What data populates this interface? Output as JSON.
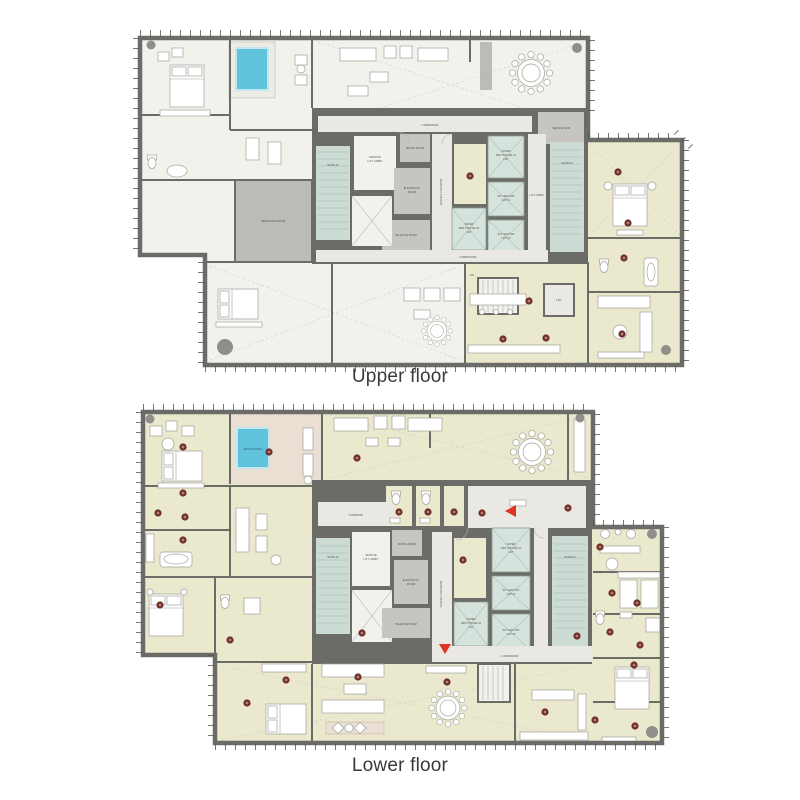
{
  "captions": {
    "upper": "Upper floor",
    "lower": "Lower floor"
  },
  "room_labels": {
    "corridor": "CORRIDOR",
    "stair_01": "STAIR 01",
    "stair_02": "STAIR 02",
    "sll_1": "SERVICE",
    "sll_2": "LIFT LOBBY",
    "waste_room": "WASTE ROOM",
    "electrical_1": "ELECTRICAL",
    "electrical_2": "ROOM",
    "telecom_room": "TELECOM ROOM",
    "service_corridor": "SERVICE CORRIDOR",
    "sp_1": "SUPER",
    "sp01_2": "PENTHOUSE 01",
    "sp02_2": "PENTHOUSE 02",
    "se_1": "SKY EDITION",
    "se01_2": "LIFT 01",
    "se02_2": "LIFT 02",
    "lift_word": "LIFT",
    "lift_lobby": "LIFT LOBBY",
    "service_room": "SERVICE ROOM",
    "service_wm": "SERVICE W/M",
    "jacuzzi_pool": "JACUZZI POOL",
    "dn": "DN"
  },
  "colors": {
    "wall": "#6b6b67",
    "room_white": "#f2f1ec",
    "room_cream": "#eae8cd",
    "room_gray": "#c6c5c1",
    "corridor": "#e9e8e3",
    "stair_teal": "#ccdcd5",
    "pool_blue": "#60c3dc",
    "pool_room_tan": "#eadfd3",
    "marker": "#6f2f27",
    "arrow_red": "#e23125",
    "caption_text": "#3a3a3a",
    "label_text": "#504f4a"
  }
}
